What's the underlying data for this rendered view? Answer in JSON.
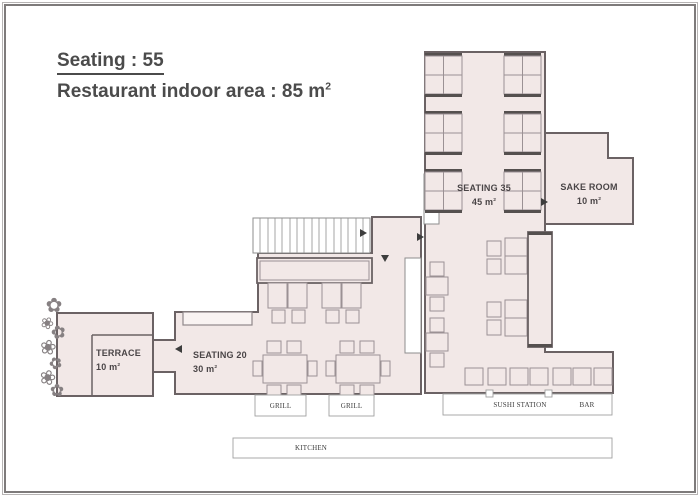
{
  "title": {
    "line1": "Seating : 55",
    "line2": "Restaurant indoor area : 85 m",
    "line2_sup": "2"
  },
  "rooms": {
    "seating35": {
      "name": "SEATING 35",
      "area": "45 m",
      "sup": "2"
    },
    "sake_room": {
      "name": "SAKE ROOM",
      "area": "10 m",
      "sup": "2"
    },
    "seating20": {
      "name": "SEATING 20",
      "area": "30 m",
      "sup": "2"
    },
    "terrace": {
      "name": "TERRACE",
      "area": "10 m",
      "sup": "2"
    }
  },
  "stations": {
    "grill_left": "GRILL",
    "grill_right": "GRILL",
    "sushi_station": "SUSHI STATION",
    "bar": "BAR",
    "kitchen": "KITCHEN"
  },
  "colors": {
    "floor_fill": "#f2e8e7",
    "wall": "#6b6264",
    "furniture_line": "#9b9194",
    "bench": "#55504f",
    "label_text": "#4a4547"
  },
  "plan": {
    "polys": [
      {
        "name": "terrace-floor",
        "cls": "floor",
        "pts": "57,313 153,313 153,396 57,396"
      },
      {
        "name": "seating20-floor",
        "cls": "floor",
        "pts": "175,312 258,312 258,253 372,253 372,217 421,217 421,394 175,394 175,372 153,372 153,340 175,340"
      },
      {
        "name": "seating35-hall-floor",
        "cls": "floor",
        "pts": "425,52 545,52 545,352 613,352 613,393 425,393"
      },
      {
        "name": "sake-room-floor",
        "cls": "floor",
        "pts": "545,133 608,133 608,158 633,158 633,224 545,224"
      }
    ],
    "rects": [
      [
        253,
        218,
        117,
        35,
        "whitebox",
        "staircase"
      ],
      [
        424,
        174,
        15,
        50,
        "whitebox",
        "door-gap"
      ],
      [
        405,
        258,
        16,
        95,
        "whitebox",
        "stair-void"
      ],
      [
        425,
        53,
        37,
        3,
        "bench",
        "booth-bench"
      ],
      [
        425,
        56,
        37,
        19,
        "furn",
        "booth-table"
      ],
      [
        425,
        75,
        37,
        19,
        "furn",
        "booth-table"
      ],
      [
        425,
        94,
        37,
        3,
        "bench",
        "booth-bench"
      ],
      [
        425,
        111,
        37,
        3,
        "bench",
        "booth-bench"
      ],
      [
        425,
        114,
        37,
        19,
        "furn",
        "booth-table"
      ],
      [
        425,
        133,
        37,
        19,
        "furn",
        "booth-table"
      ],
      [
        425,
        152,
        37,
        3,
        "bench",
        "booth-bench"
      ],
      [
        425,
        169,
        37,
        3,
        "bench",
        "booth-bench"
      ],
      [
        425,
        172,
        37,
        19,
        "furn",
        "booth-table"
      ],
      [
        425,
        191,
        37,
        19,
        "furn",
        "booth-table"
      ],
      [
        425,
        210,
        37,
        3,
        "bench",
        "booth-bench"
      ],
      [
        504,
        53,
        37,
        3,
        "bench",
        "booth-bench"
      ],
      [
        504,
        56,
        37,
        19,
        "furn",
        "booth-table"
      ],
      [
        504,
        75,
        37,
        19,
        "furn",
        "booth-table"
      ],
      [
        504,
        94,
        37,
        3,
        "bench",
        "booth-bench"
      ],
      [
        504,
        111,
        37,
        3,
        "bench",
        "booth-bench"
      ],
      [
        504,
        114,
        37,
        19,
        "furn",
        "booth-table"
      ],
      [
        504,
        133,
        37,
        19,
        "furn",
        "booth-table"
      ],
      [
        504,
        152,
        37,
        3,
        "bench",
        "booth-bench"
      ],
      [
        504,
        169,
        37,
        3,
        "bench",
        "booth-bench"
      ],
      [
        504,
        172,
        37,
        19,
        "furn",
        "booth-table"
      ],
      [
        504,
        191,
        37,
        19,
        "furn",
        "booth-table"
      ],
      [
        504,
        210,
        37,
        3,
        "bench",
        "booth-bench"
      ],
      [
        257,
        258,
        115,
        25,
        "counter",
        "grill-counter"
      ],
      [
        260,
        261,
        109,
        19,
        "counter-inner",
        "grill-counter-inner"
      ],
      [
        183,
        312,
        69,
        13,
        "shelf",
        "wall-shelf"
      ],
      [
        268,
        283,
        19,
        25,
        "furn",
        "table"
      ],
      [
        288,
        283,
        19,
        25,
        "furn",
        "table"
      ],
      [
        322,
        283,
        19,
        25,
        "furn",
        "table"
      ],
      [
        342,
        283,
        19,
        25,
        "furn",
        "table"
      ],
      [
        272,
        310,
        13,
        13,
        "furn",
        "chair"
      ],
      [
        292,
        310,
        13,
        13,
        "furn",
        "chair"
      ],
      [
        326,
        310,
        13,
        13,
        "furn",
        "chair"
      ],
      [
        346,
        310,
        13,
        13,
        "furn",
        "chair"
      ],
      [
        263,
        355,
        44,
        28,
        "furn",
        "table-four-top"
      ],
      [
        267,
        341,
        14,
        12,
        "furn",
        "chair"
      ],
      [
        287,
        341,
        14,
        12,
        "furn",
        "chair"
      ],
      [
        267,
        385,
        14,
        12,
        "furn",
        "chair"
      ],
      [
        287,
        385,
        14,
        12,
        "furn",
        "chair"
      ],
      [
        253,
        361,
        9,
        15,
        "furn",
        "chair"
      ],
      [
        308,
        361,
        9,
        15,
        "furn",
        "chair"
      ],
      [
        336,
        355,
        44,
        28,
        "furn",
        "table-four-top"
      ],
      [
        340,
        341,
        14,
        12,
        "furn",
        "chair"
      ],
      [
        360,
        341,
        14,
        12,
        "furn",
        "chair"
      ],
      [
        340,
        385,
        14,
        12,
        "furn",
        "chair"
      ],
      [
        360,
        385,
        14,
        12,
        "furn",
        "chair"
      ],
      [
        326,
        361,
        9,
        15,
        "furn",
        "chair"
      ],
      [
        381,
        361,
        9,
        15,
        "furn",
        "chair"
      ],
      [
        430,
        262,
        14,
        14,
        "furn",
        "chair"
      ],
      [
        426,
        277,
        22,
        18,
        "furn",
        "table"
      ],
      [
        430,
        297,
        14,
        14,
        "furn",
        "chair"
      ],
      [
        430,
        318,
        14,
        14,
        "furn",
        "chair"
      ],
      [
        426,
        333,
        22,
        18,
        "furn",
        "table"
      ],
      [
        430,
        353,
        14,
        14,
        "furn",
        "chair"
      ],
      [
        505,
        238,
        22,
        18,
        "furn",
        "table"
      ],
      [
        505,
        256,
        22,
        18,
        "furn",
        "table"
      ],
      [
        487,
        241,
        14,
        15,
        "furn",
        "chair"
      ],
      [
        487,
        259,
        14,
        15,
        "furn",
        "chair"
      ],
      [
        505,
        300,
        22,
        18,
        "furn",
        "table"
      ],
      [
        505,
        318,
        22,
        18,
        "furn",
        "table"
      ],
      [
        487,
        302,
        14,
        15,
        "furn",
        "chair"
      ],
      [
        487,
        320,
        14,
        15,
        "furn",
        "chair"
      ],
      [
        528,
        232,
        24,
        115,
        "counter",
        "sushi-counter"
      ],
      [
        528,
        232,
        24,
        3,
        "bench",
        "counter-cap"
      ],
      [
        528,
        344,
        24,
        3,
        "bench",
        "counter-cap"
      ],
      [
        465,
        368,
        18,
        17,
        "furn",
        "stool"
      ],
      [
        488,
        368,
        18,
        17,
        "furn",
        "stool"
      ],
      [
        510,
        368,
        18,
        17,
        "furn",
        "stool"
      ],
      [
        530,
        368,
        18,
        17,
        "furn",
        "stool"
      ],
      [
        553,
        368,
        18,
        17,
        "furn",
        "stool"
      ],
      [
        573,
        368,
        18,
        17,
        "furn",
        "stool"
      ],
      [
        594,
        368,
        18,
        17,
        "furn",
        "stool"
      ],
      [
        255,
        395,
        51,
        21,
        "stationbox",
        "grill-station-box"
      ],
      [
        329,
        395,
        45,
        21,
        "stationbox",
        "grill-station-box"
      ],
      [
        443,
        394,
        169,
        21,
        "stationbox",
        "sushi-bar-box"
      ],
      [
        233,
        438,
        379,
        20,
        "stationbox",
        "kitchen-box"
      ],
      [
        486,
        390,
        7,
        7,
        "stationbox",
        "door-tick"
      ],
      [
        545,
        390,
        7,
        7,
        "stationbox",
        "door-tick"
      ]
    ],
    "lines": [
      [
        260,
        218,
        260,
        253,
        "tread",
        "stair-tread"
      ],
      [
        268,
        218,
        268,
        253,
        "tread",
        "stair-tread"
      ],
      [
        275,
        218,
        275,
        253,
        "tread",
        "stair-tread"
      ],
      [
        282,
        218,
        282,
        253,
        "tread",
        "stair-tread"
      ],
      [
        290,
        218,
        290,
        253,
        "tread",
        "stair-tread"
      ],
      [
        297,
        218,
        297,
        253,
        "tread",
        "stair-tread"
      ],
      [
        304,
        218,
        304,
        253,
        "tread",
        "stair-tread"
      ],
      [
        312,
        218,
        312,
        253,
        "tread",
        "stair-tread"
      ],
      [
        319,
        218,
        319,
        253,
        "tread",
        "stair-tread"
      ],
      [
        326,
        218,
        326,
        253,
        "tread",
        "stair-tread"
      ],
      [
        334,
        218,
        334,
        253,
        "tread",
        "stair-tread"
      ],
      [
        341,
        218,
        341,
        253,
        "tread",
        "stair-tread"
      ],
      [
        348,
        218,
        348,
        253,
        "tread",
        "stair-tread"
      ],
      [
        356,
        218,
        356,
        253,
        "tread",
        "stair-tread"
      ],
      [
        363,
        218,
        363,
        253,
        "tread",
        "stair-tread"
      ],
      [
        443.5,
        56,
        443.5,
        94,
        "divider",
        "table-divider"
      ],
      [
        443.5,
        114,
        443.5,
        152,
        "divider",
        "table-divider"
      ],
      [
        443.5,
        172,
        443.5,
        210,
        "divider",
        "table-divider"
      ],
      [
        522.5,
        56,
        522.5,
        94,
        "divider",
        "table-divider"
      ],
      [
        522.5,
        114,
        522.5,
        152,
        "divider",
        "table-divider"
      ],
      [
        522.5,
        172,
        522.5,
        210,
        "divider",
        "table-divider"
      ],
      [
        92,
        335,
        153,
        335,
        "wall-line",
        "terrace-edge"
      ],
      [
        92,
        335,
        92,
        396,
        "wall-line",
        "terrace-edge"
      ]
    ],
    "arrows": [
      {
        "d": "r",
        "x": 360,
        "y": 229
      },
      {
        "d": "r",
        "x": 417,
        "y": 233
      },
      {
        "d": "r",
        "x": 541,
        "y": 198
      },
      {
        "d": "d",
        "x": 381,
        "y": 255
      },
      {
        "d": "l",
        "x": 175,
        "y": 345
      }
    ],
    "flowers": [
      {
        "c": "✿",
        "x": 54,
        "y": 312,
        "s": 20,
        "r": 0
      },
      {
        "c": "❀",
        "x": 45,
        "y": 328,
        "s": 16,
        "r": 25
      },
      {
        "c": "✿",
        "x": 60,
        "y": 338,
        "s": 18,
        "r": -15
      },
      {
        "c": "❀",
        "x": 47,
        "y": 354,
        "s": 20,
        "r": 10
      },
      {
        "c": "✿",
        "x": 58,
        "y": 368,
        "s": 16,
        "r": -25
      },
      {
        "c": "❀",
        "x": 46,
        "y": 384,
        "s": 20,
        "r": 15
      },
      {
        "c": "✿",
        "x": 57,
        "y": 396,
        "s": 17,
        "r": 0
      }
    ]
  }
}
